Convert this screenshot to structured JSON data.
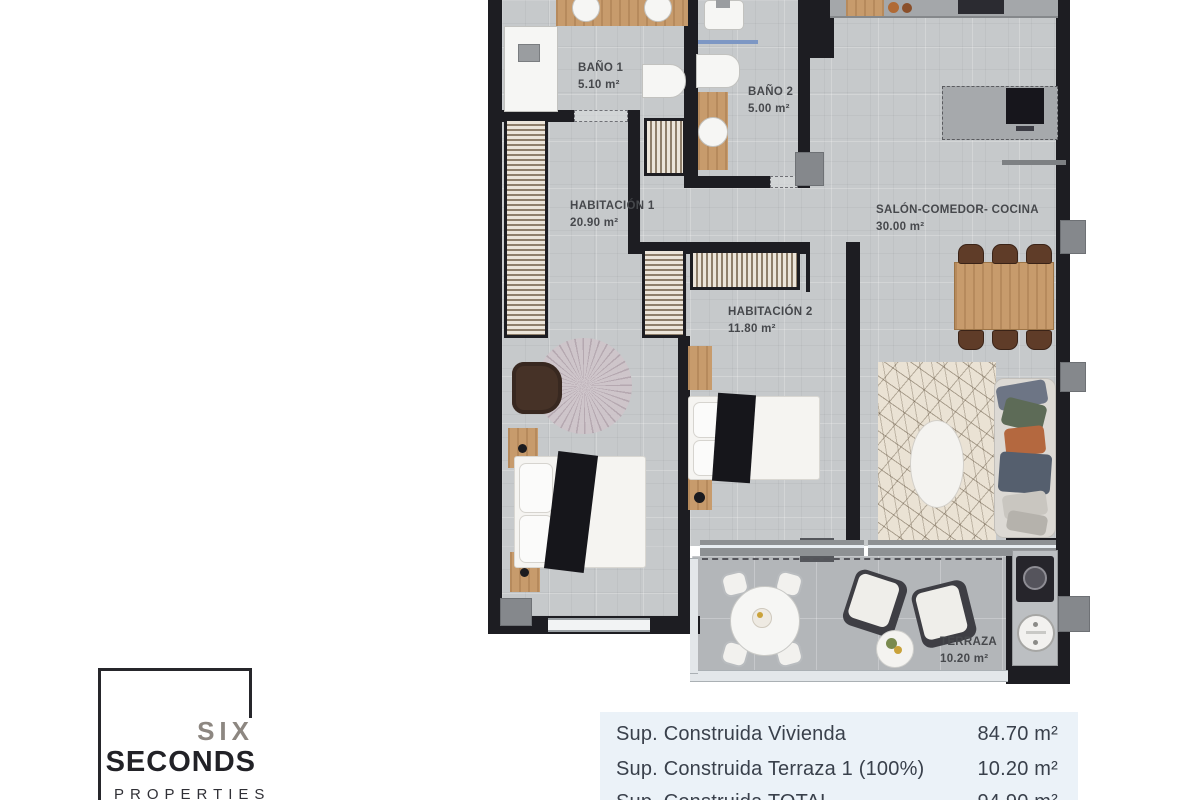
{
  "floor_plan": {
    "rooms": {
      "banyo1": {
        "name": "BAÑO 1",
        "area": "5.10 m²"
      },
      "banyo2": {
        "name": "BAÑO 2",
        "area": "5.00 m²"
      },
      "habitacion1": {
        "name": "HABITACIÓN 1",
        "area": "20.90 m²"
      },
      "habitacion2": {
        "name": "HABITACIÓN 2",
        "area": "11.80 m²"
      },
      "salon": {
        "name": "SALÓN-COMEDOR- COCINA",
        "area": "30.00 m²"
      },
      "terraza": {
        "name": "TERRAZA",
        "area": "10.20 m²"
      }
    },
    "colors": {
      "wall": "#1d1d22",
      "floor_tile": "#c6c9cb",
      "terrace_tile": "#b3b6b9",
      "wood": "#c79b6c",
      "label_text": "#46484c"
    }
  },
  "logo": {
    "line1": "SIX",
    "line2": "SECONDS",
    "line3": "PROPERTIES"
  },
  "summary_table": {
    "background": "#ebf2f8",
    "rows": [
      {
        "label": "Sup. Construida Vivienda",
        "value": "84.70 m²"
      },
      {
        "label": "Sup. Construida Terraza 1 (100%)",
        "value": "10.20 m²"
      },
      {
        "label": "Sup. Construida TOTAL",
        "value": "94.90 m²"
      }
    ]
  }
}
